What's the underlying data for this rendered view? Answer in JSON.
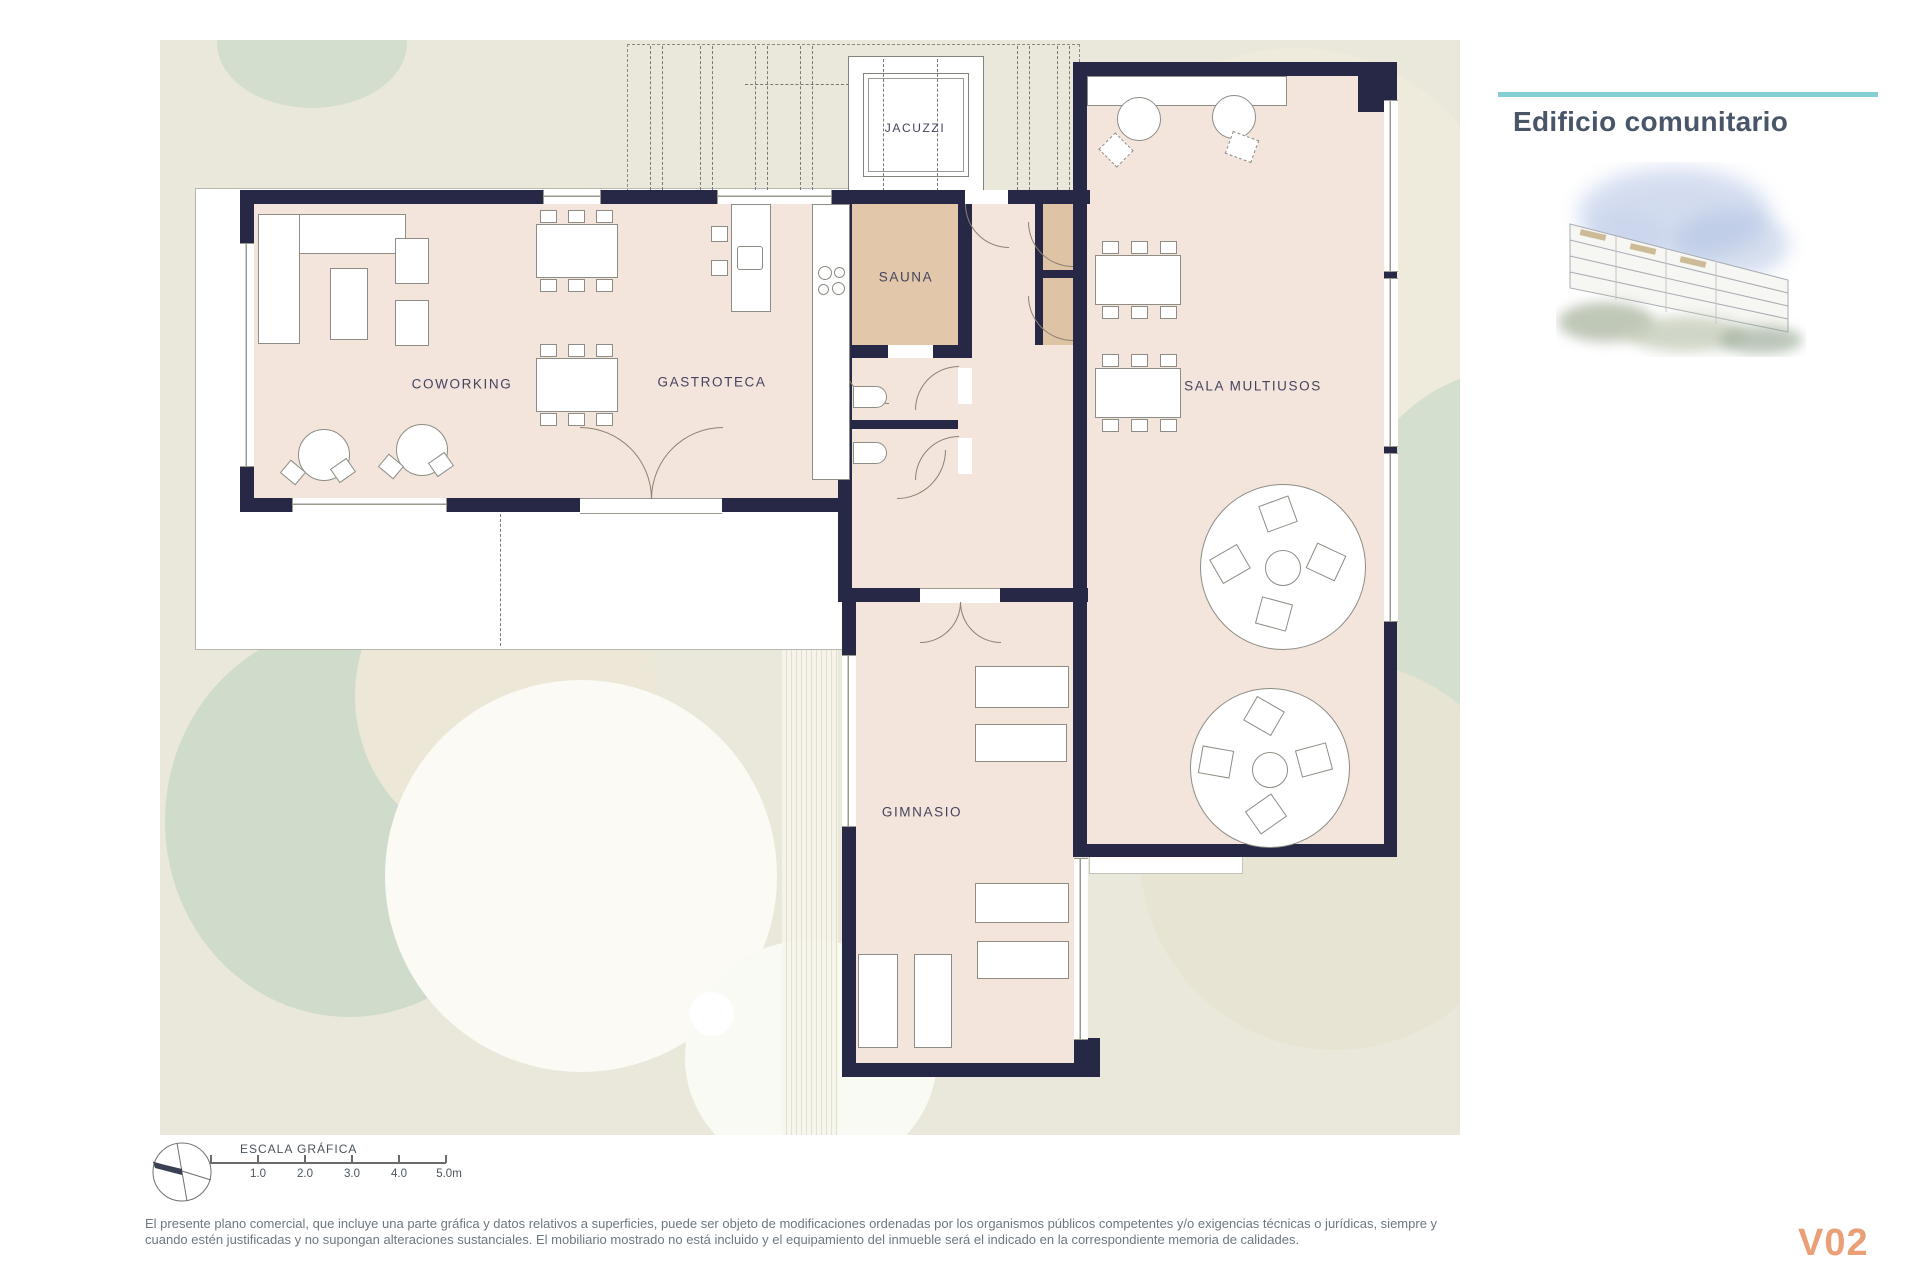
{
  "header": {
    "title": "Edificio comunitario"
  },
  "plan": {
    "rooms": [
      {
        "label": "JACUZZI"
      },
      {
        "label": "SAUNA"
      },
      {
        "label": "COWORKING"
      },
      {
        "label": "GASTROTECA"
      },
      {
        "label": "SALA MULTIUSOS"
      },
      {
        "label": "GIMNASIO"
      }
    ],
    "colors": {
      "wall": "#262845",
      "floor": "#f3e4dc",
      "sauna_floor": "#e2c7aa",
      "closet_floor": "#dfc3a5",
      "terrace": "#ffffff",
      "landscape": "#eae8da",
      "vegetation": "#d3decf",
      "accent_teal": "#87ced2",
      "version_orange": "#ea9f76",
      "title_slate": "#49566a"
    }
  },
  "scale_bar": {
    "title": "ESCALA GRÁFICA",
    "ticks": [
      "1.0",
      "2.0",
      "3.0",
      "4.0",
      "5.0m"
    ]
  },
  "footer": {
    "disclaimer_line1": "El presente plano comercial, que incluye una parte gráfica y datos relativos a superficies, puede ser objeto de modificaciones ordenadas por los organismos públicos competentes y/o exigencias técnicas o jurídicas, siempre y",
    "disclaimer_line2": "cuando estén justificadas y no supongan alteraciones sustanciales. El mobiliario mostrado no está incluido y el equipamiento del inmueble será el indicado en la correspondiente memoria de calidades.",
    "version": "V02"
  }
}
